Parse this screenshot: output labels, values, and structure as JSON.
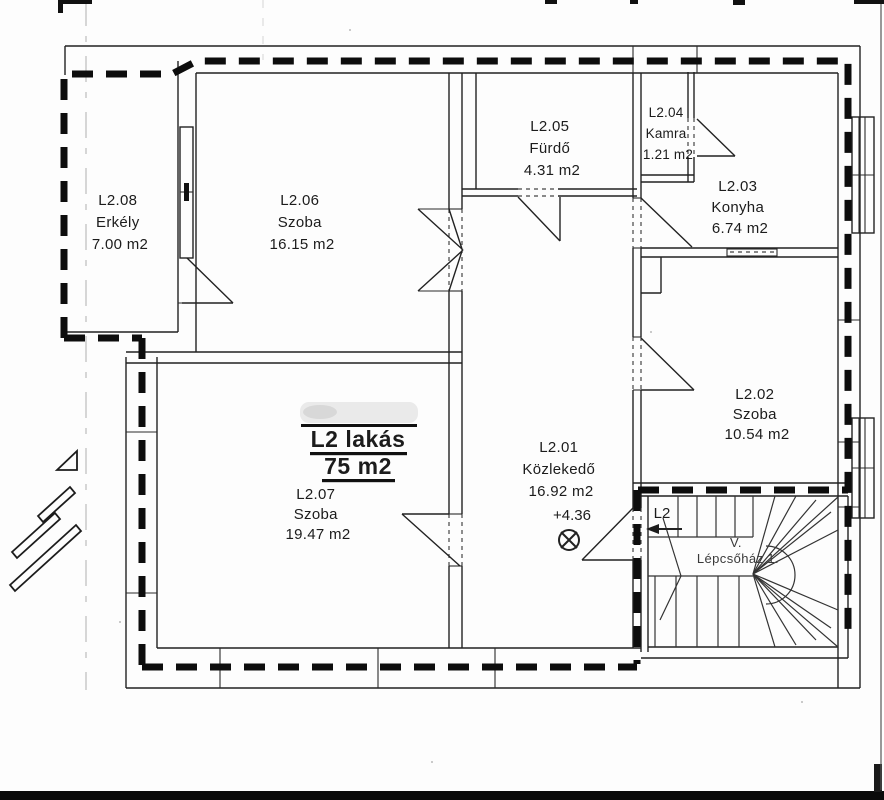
{
  "title_block": {
    "apartment_label": "L2 lakás",
    "apartment_area": "75 m2"
  },
  "rooms": [
    {
      "id": "L2.01",
      "name": "Közlekedő",
      "area": "16.92 m2"
    },
    {
      "id": "L2.02",
      "name": "Szoba",
      "area": "10.54 m2"
    },
    {
      "id": "L2.03",
      "name": "Konyha",
      "area": "6.74 m2"
    },
    {
      "id": "L2.04",
      "name": "Kamra",
      "area": "1.21 m2"
    },
    {
      "id": "L2.05",
      "name": "Fürdő",
      "area": "4.31 m2"
    },
    {
      "id": "L2.06",
      "name": "Szoba",
      "area": "16.15 m2"
    },
    {
      "id": "L2.07",
      "name": "Szoba",
      "area": "19.47 m2"
    },
    {
      "id": "L2.08",
      "name": "Erkély",
      "area": "7.00 m2"
    }
  ],
  "annotations": {
    "level_mark": "+4.36",
    "entry_label": "L2",
    "stair_line1": "V.",
    "stair_line2": "Lépcsőház 1."
  },
  "colors": {
    "line": "#1f1f1f",
    "boundary": "#0d0d0d",
    "stair_text": "#3a3a3a",
    "paper": "#fdfdfd"
  }
}
